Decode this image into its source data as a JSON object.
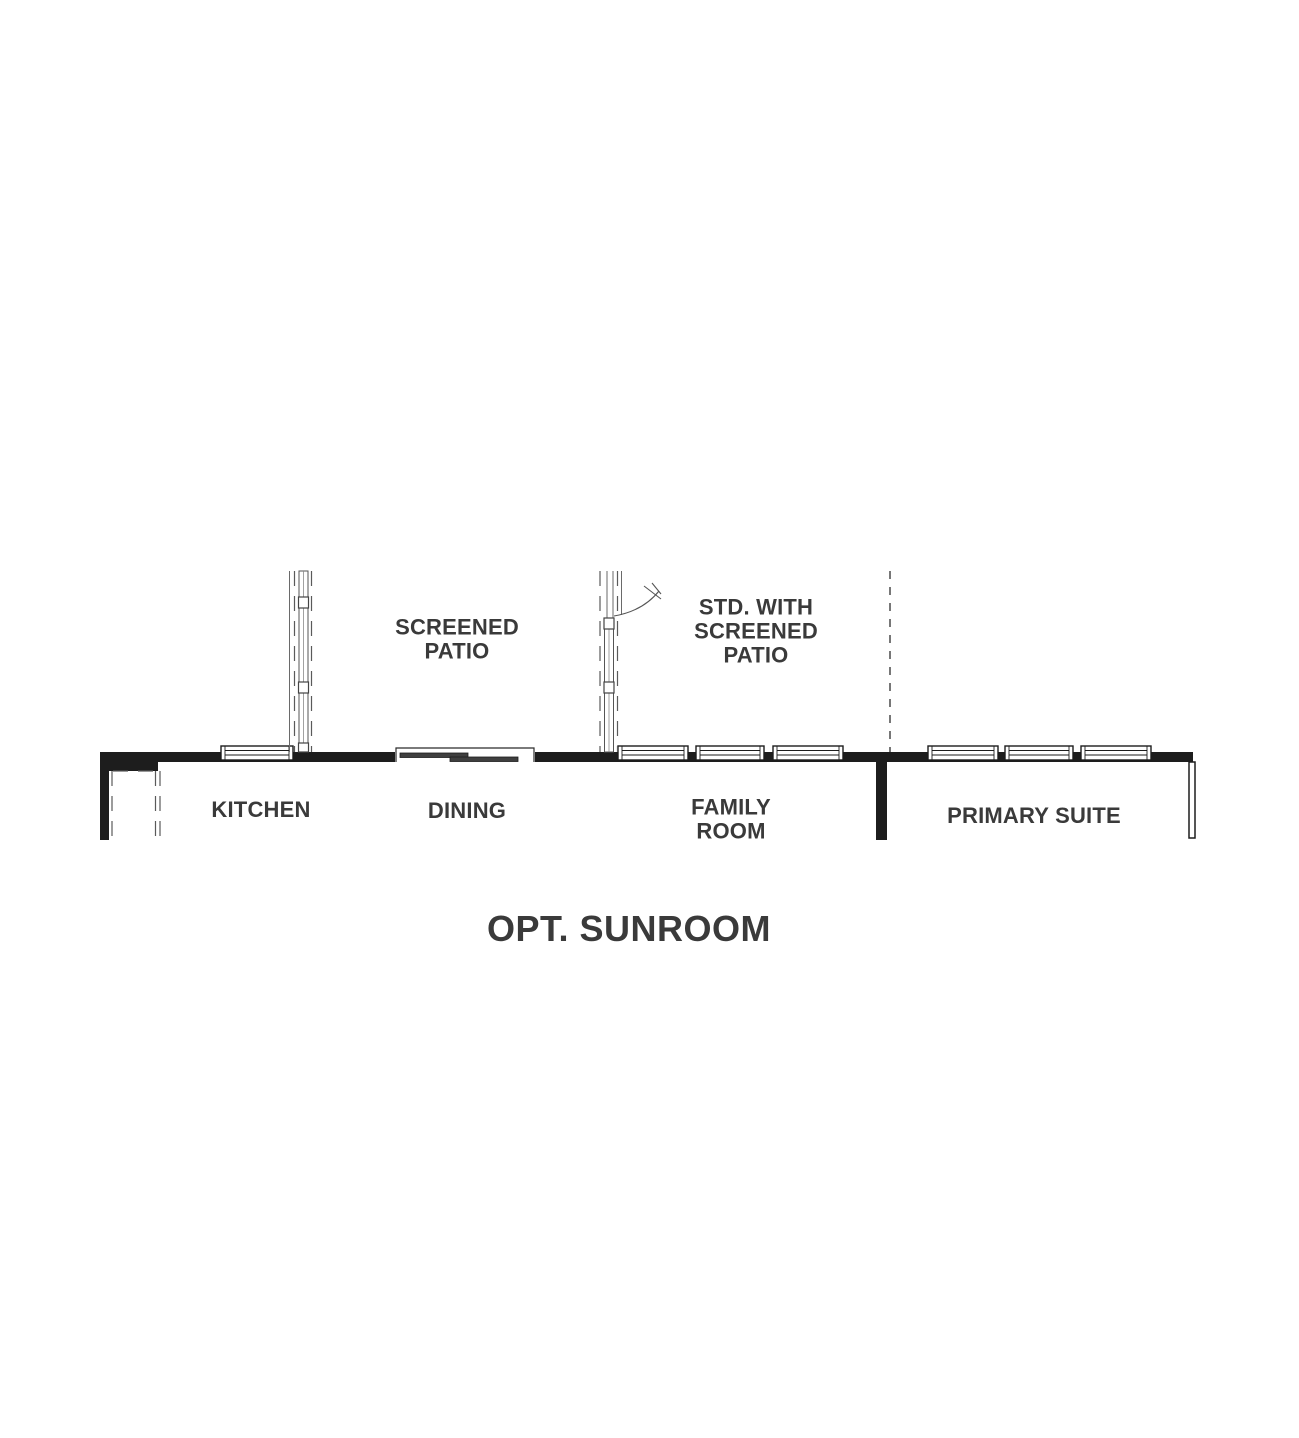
{
  "plan": {
    "title": "OPT. SUNROOM",
    "labels": {
      "screened_patio": "SCREENED\nPATIO",
      "std_screened_patio": "STD. WITH\nSCREENED\nPATIO",
      "kitchen": "KITCHEN",
      "dining": "DINING",
      "family_room": "FAMILY\nROOM",
      "primary_suite": "PRIMARY SUITE"
    },
    "colors": {
      "wall": "#1d1d1d",
      "text": "#3a3a3a",
      "thin_line": "#5a5a5a",
      "door_panel": "#3f3f3f",
      "background": "#ffffff"
    }
  }
}
